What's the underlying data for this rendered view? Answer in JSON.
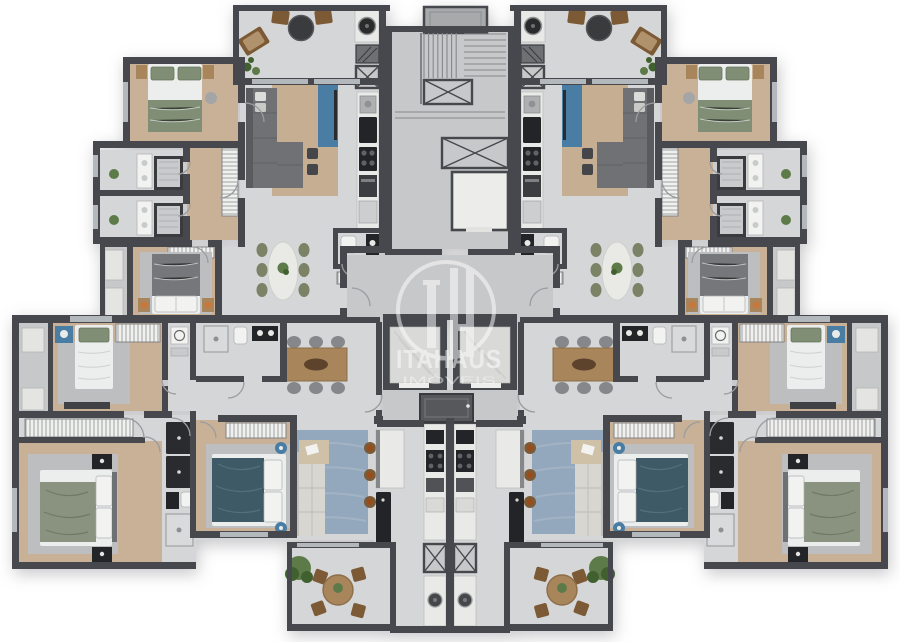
{
  "watermark": {
    "brand": "ITAHAUS",
    "tagline": "IMÓVEIS",
    "monogram": "IH"
  },
  "plan": {
    "type": "residential-floor-plan",
    "apartments_visible": 4,
    "elevators": 2,
    "stairwells": 1,
    "mirror_symmetry": "vertical-center"
  },
  "palette": {
    "background": "#ffffff",
    "wall": "#46484d",
    "floor": "#d5d6d7",
    "floor_shaded": "#c7c8ca",
    "wood": "#c9b197",
    "rug": "#bcbebf",
    "rug_tan": "#c6ae93",
    "rug_blue": "#94a8bd",
    "marble": "#e9e9e7",
    "appliance": "#232427",
    "sofa": "#6f7174",
    "sofa_dark": "#595b5e",
    "sofa_light": "#d8d6d1",
    "bed_white": "#eceded",
    "bed_green": "#7f8e75",
    "bed_teal": "#3e5a66",
    "bed_gray": "#75777a",
    "blanket_sage": "#8a937f",
    "wood_furniture": "#a9855c",
    "wood_dark": "#7d5a36",
    "chair_olive": "#7b8266",
    "plant": "#5d7b49",
    "plant_dark": "#41602f",
    "accent_blue": "#4a7da3",
    "lamp_orange": "#c9773b",
    "table_black": "#3a3b3d",
    "elevator": "#d9d9d8",
    "window": "#b3b8bc",
    "duct_dark": "#56585c",
    "duct_light": "#a7a9ab",
    "machine_room": "#ececea",
    "watermark_white": "#ffffff"
  }
}
